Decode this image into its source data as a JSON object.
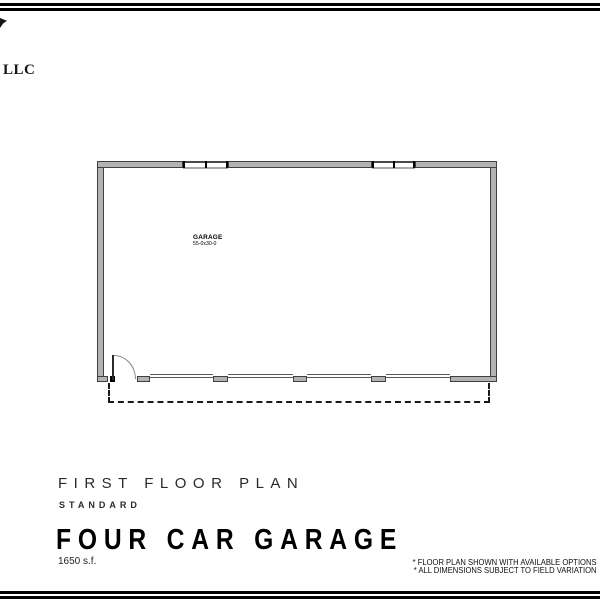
{
  "header": {
    "logo_text": "LLC"
  },
  "plan": {
    "room_label": "GARAGE",
    "room_dimensions": "55-0x30-0"
  },
  "title_block": {
    "plan_title": "FIRST FLOOR PLAN",
    "plan_subtitle": "STANDARD",
    "model_name": "FOUR CAR GARAGE",
    "area": "1650 s.f."
  },
  "notes": {
    "line1": "* FLOOR PLAN SHOWN WITH AVAILABLE OPTIONS",
    "line2": "* ALL DIMENSIONS SUBJECT TO FIELD VARIATION"
  },
  "colors": {
    "wall_fill": "#b3b3b3",
    "wall_edge": "#3f3f3f",
    "line": "#000000"
  }
}
